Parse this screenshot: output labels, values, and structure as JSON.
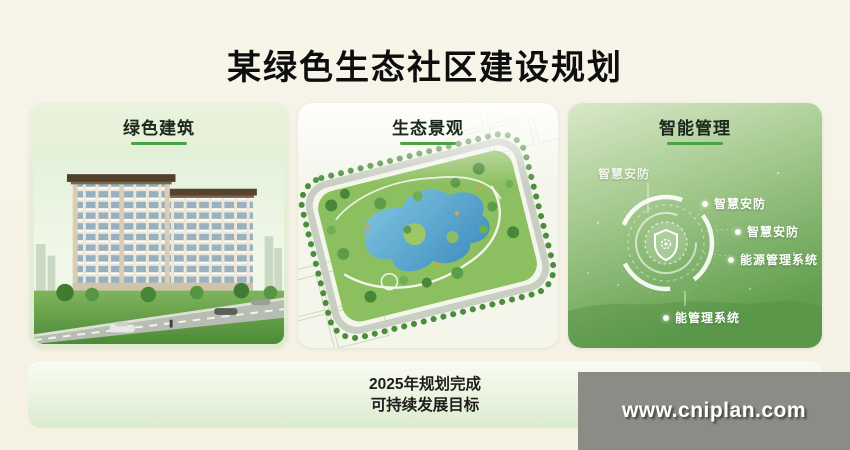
{
  "slide": {
    "title": "某绿色生态社区建设规划",
    "footer_line1": "2025年规划完成",
    "footer_line2": "可持续发展目标"
  },
  "panels": {
    "building": {
      "label": "绿色建筑",
      "image_name": "residential-building-render"
    },
    "landscape": {
      "label": "生态景观",
      "image_name": "park-aerial-plan"
    },
    "smart": {
      "label": "智能管理",
      "image_name": "smart-management-diagram",
      "center_icon": "shield-gear-icon",
      "labels": {
        "top_left": "智慧安防",
        "right_1": "智慧安防",
        "right_2": "智慧安防",
        "right_3": "能源管理系统",
        "bottom": "能管理系统"
      }
    }
  },
  "watermark": {
    "text": "www.cniplan.com"
  },
  "colors": {
    "page_bg": "#f6f3e6",
    "card_bg": "#e6f0da",
    "accent_green": "#4aa345",
    "title_text": "#0e0e0e",
    "diagram_bg_top": "#d9e9ca",
    "diagram_bg_bottom": "#619e4e",
    "lake_blue": "#4d9cc9",
    "watermark_bg": "#8b8c86",
    "watermark_text": "#ffffff"
  }
}
